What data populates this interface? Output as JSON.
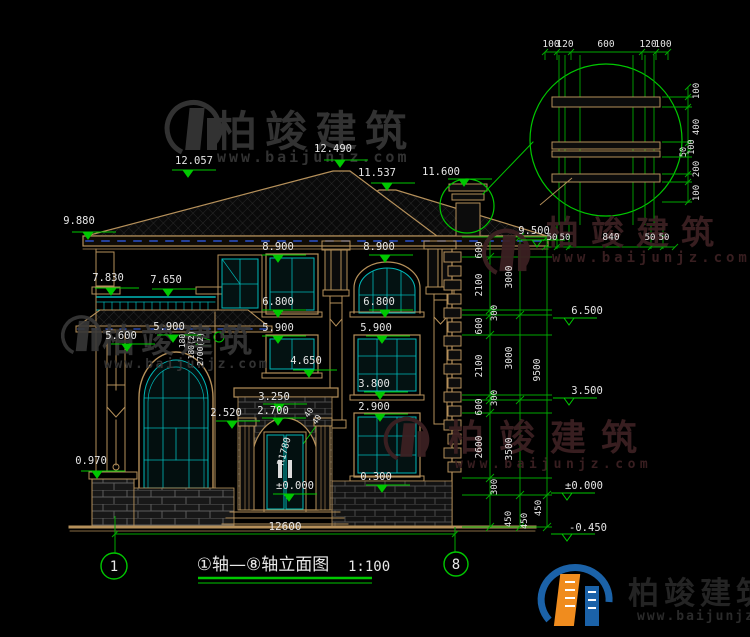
{
  "watermark": {
    "brand": "柏竣建筑",
    "site": "www.baijunjz.com"
  },
  "title": {
    "text": "①轴—⑧轴立面图",
    "scale": "1:100"
  },
  "axis": {
    "left": "1",
    "right": "8"
  },
  "total_width": "12600",
  "labels": [
    {
      "t": "12.057",
      "x": 194,
      "y": 164,
      "tri": [
        188,
        177,
        1
      ]
    },
    {
      "t": "9.880",
      "x": 79,
      "y": 224,
      "tri": [
        88,
        239,
        1
      ]
    },
    {
      "t": "7.830",
      "x": 108,
      "y": 281,
      "tri": [
        111,
        295,
        1
      ]
    },
    {
      "t": "7.650",
      "x": 166,
      "y": 283,
      "tri": [
        168,
        296,
        1
      ]
    },
    {
      "t": "5.600",
      "x": 121,
      "y": 339,
      "tri": [
        127,
        351,
        1
      ]
    },
    {
      "t": "5.900",
      "x": 169,
      "y": 330,
      "tri": [
        173,
        342,
        1
      ]
    },
    {
      "t": "0.970",
      "x": 91,
      "y": 464,
      "tri": [
        97,
        478,
        1
      ]
    },
    {
      "t": "12.490",
      "x": 333,
      "y": 152,
      "tri": [
        340,
        167,
        1
      ]
    },
    {
      "t": "11.537",
      "x": 377,
      "y": 176,
      "tri": [
        387,
        190,
        1
      ]
    },
    {
      "t": "11.600",
      "x": 441,
      "y": 175,
      "tri": [
        464,
        186,
        1
      ]
    },
    {
      "t": "8.900",
      "x": 278,
      "y": 250,
      "tri": [
        278,
        262,
        1
      ]
    },
    {
      "t": "6.800",
      "x": 278,
      "y": 305,
      "tri": [
        278,
        317,
        1
      ]
    },
    {
      "t": "5.900",
      "x": 278,
      "y": 331,
      "tri": [
        278,
        343,
        1
      ]
    },
    {
      "t": "4.650",
      "x": 306,
      "y": 364,
      "tri": [
        309,
        377,
        1
      ]
    },
    {
      "t": "8.900",
      "x": 379,
      "y": 250,
      "tri": [
        385,
        262,
        1
      ]
    },
    {
      "t": "6.800",
      "x": 379,
      "y": 305,
      "tri": [
        385,
        317,
        1
      ]
    },
    {
      "t": "5.900",
      "x": 376,
      "y": 331,
      "tri": [
        382,
        343,
        1
      ]
    },
    {
      "t": "3.800",
      "x": 374,
      "y": 387,
      "tri": [
        380,
        399,
        1
      ]
    },
    {
      "t": "2.900",
      "x": 374,
      "y": 410,
      "tri": [
        380,
        421,
        1
      ]
    },
    {
      "t": "0.300",
      "x": 376,
      "y": 480,
      "tri": [
        382,
        492,
        1
      ]
    },
    {
      "t": "3.250",
      "x": 274,
      "y": 400,
      "tri": [
        279,
        411,
        1
      ]
    },
    {
      "t": "2.700",
      "x": 273,
      "y": 414,
      "tri": [
        278,
        425,
        1
      ]
    },
    {
      "t": "2.520",
      "x": 226,
      "y": 416,
      "tri": [
        232,
        428,
        1
      ]
    },
    {
      "t": "±0.000",
      "x": 295,
      "y": 489,
      "tri": [
        289,
        501,
        1
      ]
    },
    {
      "t": "R1780",
      "x": 287,
      "y": 452,
      "r": -75,
      "s": 9.5
    },
    {
      "t": "9.500",
      "x": 534,
      "y": 234,
      "tri": [
        537,
        247,
        0
      ]
    },
    {
      "t": "6.500",
      "x": 587,
      "y": 314,
      "tri": [
        569,
        325,
        0
      ]
    },
    {
      "t": "3.500",
      "x": 587,
      "y": 394,
      "tri": [
        569,
        405,
        0
      ]
    },
    {
      "t": "±0.000",
      "x": 584,
      "y": 489,
      "tri": [
        567,
        500,
        0
      ]
    },
    {
      "t": "-0.450",
      "x": 588,
      "y": 531,
      "tri": [
        567,
        541,
        0
      ]
    },
    {
      "t": "600",
      "x": 482,
      "y": 250,
      "r": -90,
      "s": 9.5
    },
    {
      "t": "2100",
      "x": 482,
      "y": 285,
      "r": -90,
      "s": 9.5
    },
    {
      "t": "300",
      "x": 497,
      "y": 313,
      "r": -90,
      "s": 9
    },
    {
      "t": "600",
      "x": 482,
      "y": 326,
      "r": -90,
      "s": 9.5
    },
    {
      "t": "2100",
      "x": 482,
      "y": 366,
      "r": -90,
      "s": 9.5
    },
    {
      "t": "300",
      "x": 497,
      "y": 398,
      "r": -90,
      "s": 9
    },
    {
      "t": "600",
      "x": 482,
      "y": 407,
      "r": -90,
      "s": 9.5
    },
    {
      "t": "2600",
      "x": 482,
      "y": 447,
      "r": -90,
      "s": 9.5
    },
    {
      "t": "300",
      "x": 497,
      "y": 487,
      "r": -90,
      "s": 9
    },
    {
      "t": "450",
      "x": 511,
      "y": 519,
      "r": -90,
      "s": 9
    },
    {
      "t": "3000",
      "x": 512,
      "y": 277,
      "r": -90,
      "s": 9.5
    },
    {
      "t": "3000",
      "x": 512,
      "y": 358,
      "r": -90,
      "s": 9.5
    },
    {
      "t": "3500",
      "x": 512,
      "y": 449,
      "r": -90,
      "s": 9.5
    },
    {
      "t": "450",
      "x": 527,
      "y": 521,
      "r": -90,
      "s": 9
    },
    {
      "t": "9500",
      "x": 540,
      "y": 370,
      "r": -90,
      "s": 9.5
    },
    {
      "t": "450",
      "x": 541,
      "y": 508,
      "r": -90,
      "s": 9
    },
    {
      "t": "50",
      "x": 552,
      "y": 240,
      "s": 9
    },
    {
      "t": "50",
      "x": 565,
      "y": 240,
      "s": 9
    },
    {
      "t": "840",
      "x": 611,
      "y": 240,
      "s": 9.5
    },
    {
      "t": "50",
      "x": 650,
      "y": 240,
      "s": 9
    },
    {
      "t": "50",
      "x": 664,
      "y": 240,
      "s": 9
    },
    {
      "t": "100",
      "x": 551,
      "y": 47,
      "s": 9.5
    },
    {
      "t": "120",
      "x": 565,
      "y": 47,
      "s": 9.5
    },
    {
      "t": "600",
      "x": 606,
      "y": 47,
      "s": 9.5
    },
    {
      "t": "120",
      "x": 648,
      "y": 47,
      "s": 9.5
    },
    {
      "t": "100",
      "x": 663,
      "y": 47,
      "s": 9.5
    },
    {
      "t": "100",
      "x": 699,
      "y": 91,
      "r": -90,
      "s": 9
    },
    {
      "t": "400",
      "x": 699,
      "y": 127,
      "r": -90,
      "s": 9
    },
    {
      "t": "100",
      "x": 694,
      "y": 147,
      "r": -90,
      "s": 8.5
    },
    {
      "t": "50",
      "x": 686,
      "y": 152,
      "r": -90,
      "s": 8.5
    },
    {
      "t": "200",
      "x": 699,
      "y": 169,
      "r": -90,
      "s": 9
    },
    {
      "t": "100",
      "x": 699,
      "y": 193,
      "r": -90,
      "s": 9
    },
    {
      "t": "180",
      "x": 185,
      "y": 341,
      "r": -90,
      "s": 8
    },
    {
      "t": "180(2)",
      "x": 194,
      "y": 345,
      "r": -90,
      "s": 8
    },
    {
      "t": "2700(2)",
      "x": 203,
      "y": 349,
      "r": -90,
      "s": 8
    },
    {
      "t": "40",
      "x": 311,
      "y": 414,
      "r": -55,
      "s": 8
    },
    {
      "t": "40",
      "x": 319,
      "y": 421,
      "r": -55,
      "s": 8
    },
    {
      "t": "12600",
      "x": 285,
      "y": 530,
      "s": 11
    }
  ]
}
